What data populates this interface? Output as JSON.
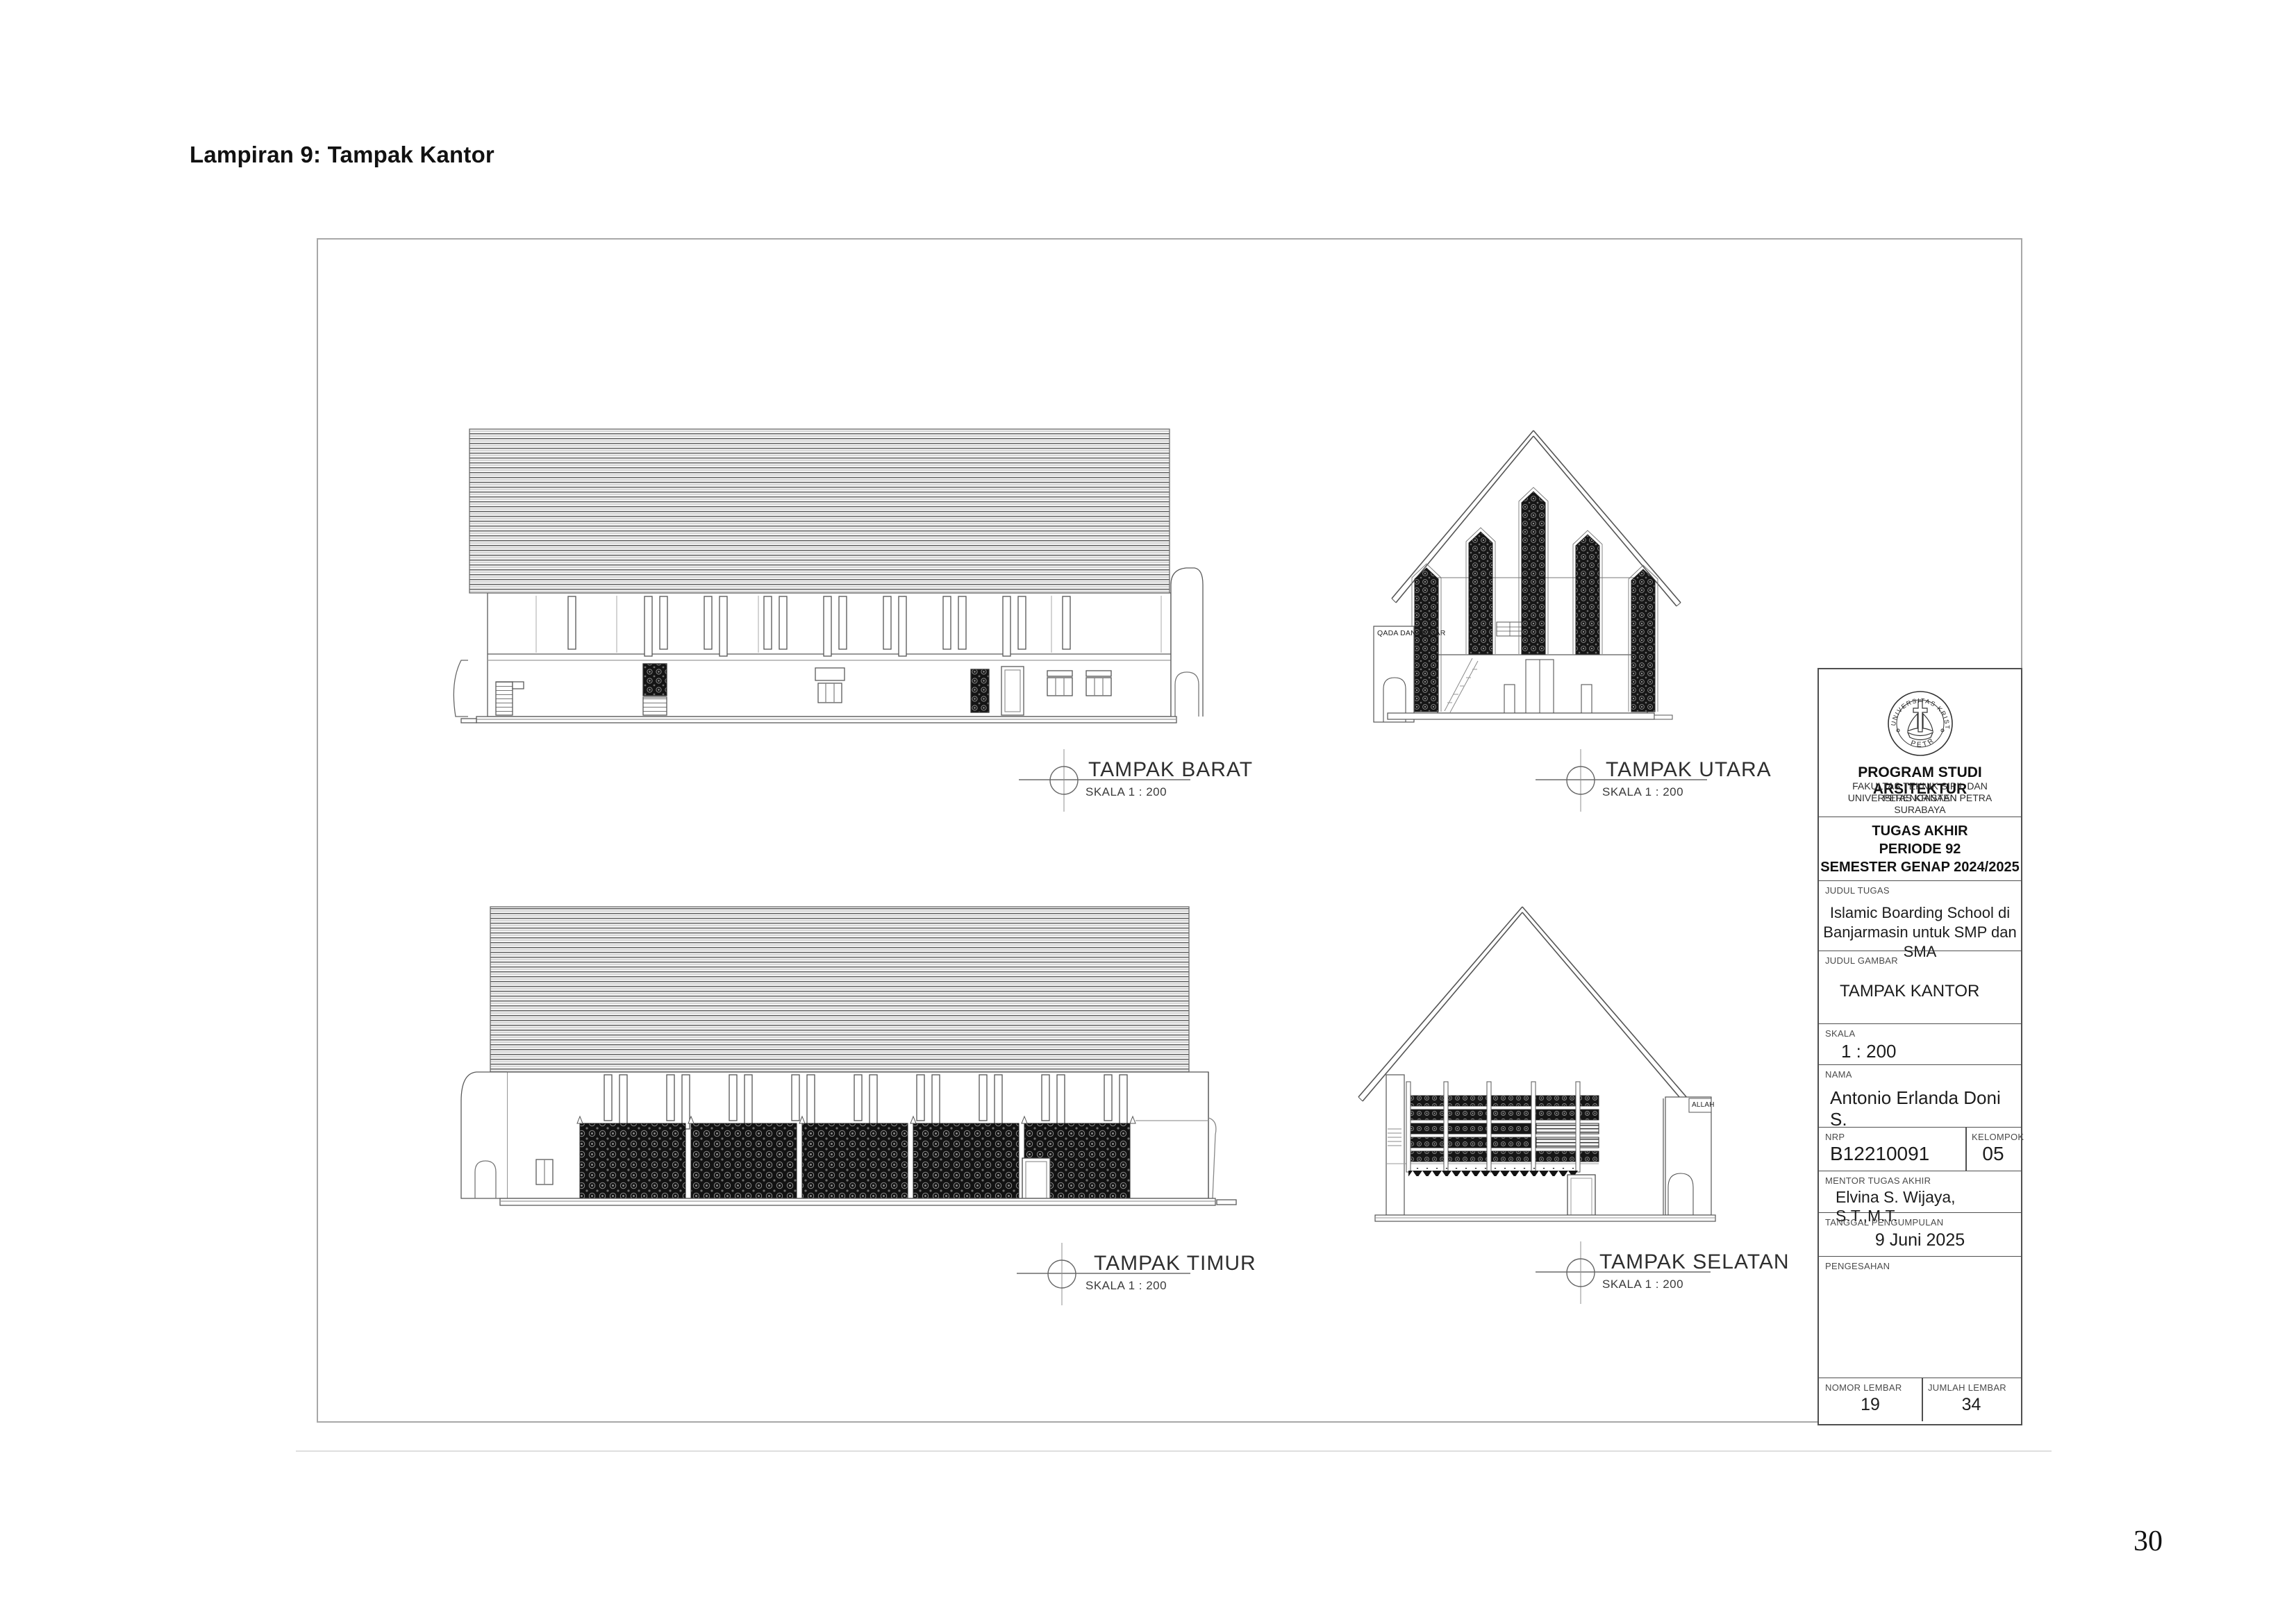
{
  "page": {
    "heading": "Lampiran 9: Tampak Kantor",
    "page_number": "30"
  },
  "elevations": [
    {
      "title": "TAMPAK BARAT",
      "scale": "SKALA 1 : 200"
    },
    {
      "title": "TAMPAK UTARA",
      "scale": "SKALA 1 : 200",
      "annotation": "QADA DAN QODAR"
    },
    {
      "title": "TAMPAK TIMUR",
      "scale": "SKALA 1 : 200"
    },
    {
      "title": "TAMPAK SELATAN",
      "scale": "SKALA 1 : 200",
      "annotation": "ALLAH"
    }
  ],
  "title_block": {
    "logo": {
      "arc_top": "UNIVERSITAS KRISTEN",
      "arc_bottom": "PETRA"
    },
    "program": "PROGRAM STUDI ARSITEKTUR",
    "faculty": "FAKULTAS TEKNIK SIPIL DAN PERENCANAAN",
    "university": "UNIVERSITAS KRISTEN PETRA",
    "city": "SURABAYA",
    "course_line1": "TUGAS AKHIR",
    "course_line2": "PERIODE 92",
    "course_line3": "SEMESTER GENAP 2024/2025",
    "judul_tugas_label": "JUDUL TUGAS",
    "judul_tugas_line1": "Islamic Boarding School di",
    "judul_tugas_line2": "Banjarmasin untuk SMP dan SMA",
    "judul_gambar_label": "JUDUL GAMBAR",
    "judul_gambar": "TAMPAK KANTOR",
    "skala_label": "SKALA",
    "skala": "1 : 200",
    "nama_label": "NAMA",
    "nama": "Antonio Erlanda Doni S.",
    "nrp_label": "NRP",
    "nrp": "B12210091",
    "kelompok_label": "KELOMPOK",
    "kelompok": "05",
    "mentor_label": "MENTOR TUGAS AKHIR",
    "mentor": "Elvina S. Wijaya, S.T.,M.T.",
    "tanggal_label": "TANGGAL PENGUMPULAN",
    "tanggal": "9 Juni 2025",
    "pengesahan_label": "PENGESAHAN",
    "nomor_label": "NOMOR LEMBAR",
    "nomor": "19",
    "jumlah_label": "JUMLAH LEMBAR",
    "jumlah": "34"
  }
}
